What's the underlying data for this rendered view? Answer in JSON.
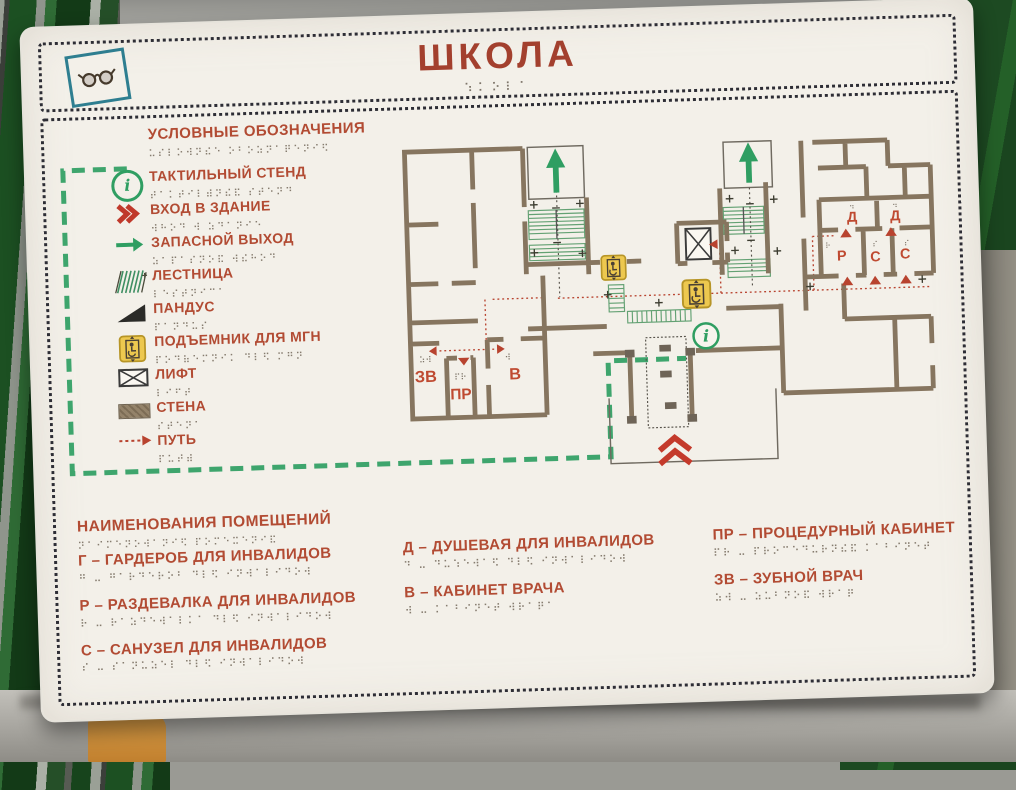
{
  "sign": {
    "title": "ШКОЛА",
    "title_braille": "⠱⠅⠕⠇⠁",
    "legend": {
      "header": "УСЛОВНЫЕ ОБОЗНАЧЕНИЯ",
      "header_braille": "⠥⠎⠇⠕⠺⠝⠮⠑ ⠕⠃⠕⠵⠝⠁⠟⠑⠝⠊⠫",
      "items": [
        {
          "icon": "info-circle",
          "label": "ТАКТИЛЬНЫЙ СТЕНД",
          "braille": "⠞⠁⠅⠞⠊⠇⠾⠝⠮⠯ ⠎⠞⠑⠝⠙"
        },
        {
          "icon": "entrance-chevrons",
          "label": "ВХОД В ЗДАНИЕ",
          "braille": "⠺⠓⠕⠙ ⠺ ⠵⠙⠁⠝⠊⠑"
        },
        {
          "icon": "exit-arrow",
          "label": "ЗАПАСНОЙ ВЫХОД",
          "braille": "⠵⠁⠏⠁⠎⠝⠕⠯ ⠺⠮⠓⠕⠙"
        },
        {
          "icon": "stairs",
          "label": "ЛЕСТНИЦА",
          "braille": "⠇⠑⠎⠞⠝⠊⠉⠁"
        },
        {
          "icon": "ramp",
          "label": "ПАНДУС",
          "braille": "⠏⠁⠝⠙⠥⠎"
        },
        {
          "icon": "wheelchair-lift",
          "label": "ПОДЪЕМНИК ДЛЯ МГН",
          "braille": "⠏⠕⠙⠷⠑⠍⠝⠊⠅ ⠙⠇⠫ ⠍⠛⠝"
        },
        {
          "icon": "elevator",
          "label": "ЛИФТ",
          "braille": "⠇⠊⠋⠞"
        },
        {
          "icon": "wall",
          "label": "СТЕНА",
          "braille": "⠎⠞⠑⠝⠁"
        },
        {
          "icon": "path",
          "label": "ПУТЬ",
          "braille": "⠏⠥⠞⠾"
        }
      ]
    },
    "rooms": {
      "header": "НАИМЕНОВАНИЯ ПОМЕЩЕНИЙ",
      "header_braille": "⠝⠁⠊⠍⠑⠝⠕⠺⠁⠝⠊⠫ ⠏⠕⠍⠑⠭⠑⠝⠊⠯",
      "columns": [
        [
          {
            "label": "Г – ГАРДЕРОБ ДЛЯ ИНВАЛИДОВ",
            "braille": "⠛ ⠤ ⠛⠁⠗⠙⠑⠗⠕⠃ ⠙⠇⠫ ⠊⠝⠺⠁⠇⠊⠙⠕⠺"
          },
          {
            "label": "Р – РАЗДЕВАЛКА ДЛЯ ИНВАЛИДОВ",
            "braille": "⠗ ⠤ ⠗⠁⠵⠙⠑⠺⠁⠇⠅⠁ ⠙⠇⠫ ⠊⠝⠺⠁⠇⠊⠙⠕⠺"
          },
          {
            "label": "С – САНУЗЕЛ ДЛЯ ИНВАЛИДОВ",
            "braille": "⠎ ⠤ ⠎⠁⠝⠥⠵⠑⠇ ⠙⠇⠫ ⠊⠝⠺⠁⠇⠊⠙⠕⠺"
          }
        ],
        [
          {
            "label": "Д – ДУШЕВАЯ ДЛЯ ИНВАЛИДОВ",
            "braille": "⠙ ⠤ ⠙⠥⠱⠑⠺⠁⠫ ⠙⠇⠫ ⠊⠝⠺⠁⠇⠊⠙⠕⠺"
          },
          {
            "label": "В – КАБИНЕТ ВРАЧА",
            "braille": "⠺ ⠤ ⠅⠁⠃⠊⠝⠑⠞ ⠺⠗⠁⠟⠁"
          }
        ],
        [
          {
            "label": "ПР – ПРОЦЕДУРНЫЙ КАБИНЕТ",
            "braille": "⠏⠗ ⠤ ⠏⠗⠕⠉⠑⠙⠥⠗⠝⠮⠯ ⠅⠁⠃⠊⠝⠑⠞"
          },
          {
            "label": "ЗВ – ЗУБНОЙ ВРАЧ",
            "braille": "⠵⠺ ⠤ ⠵⠥⠃⠝⠕⠯ ⠺⠗⠁⠟"
          }
        ]
      ]
    },
    "plan": {
      "rooms": {
        "zv": "ЗВ",
        "pr": "ПР",
        "v": "В",
        "d1": "Д",
        "d2": "Д",
        "r": "Р",
        "s1": "С",
        "s2": "С"
      },
      "braille": {
        "zv": "⠵⠺",
        "pr": "⠏⠗",
        "v": "⠺",
        "d": "⠙",
        "r": "⠗",
        "s": "⠎"
      }
    },
    "colors": {
      "accent_red": "#b24b33",
      "title_red": "#a3402e",
      "green": "#2f9e62",
      "wall_brown": "#86755f",
      "lift_yellow": "#edc84f",
      "board": "#f3f0e9",
      "border_dots": "#2d2d35",
      "bg_green": "#1d4a22",
      "glasses_teal": "#2e7e90"
    }
  }
}
